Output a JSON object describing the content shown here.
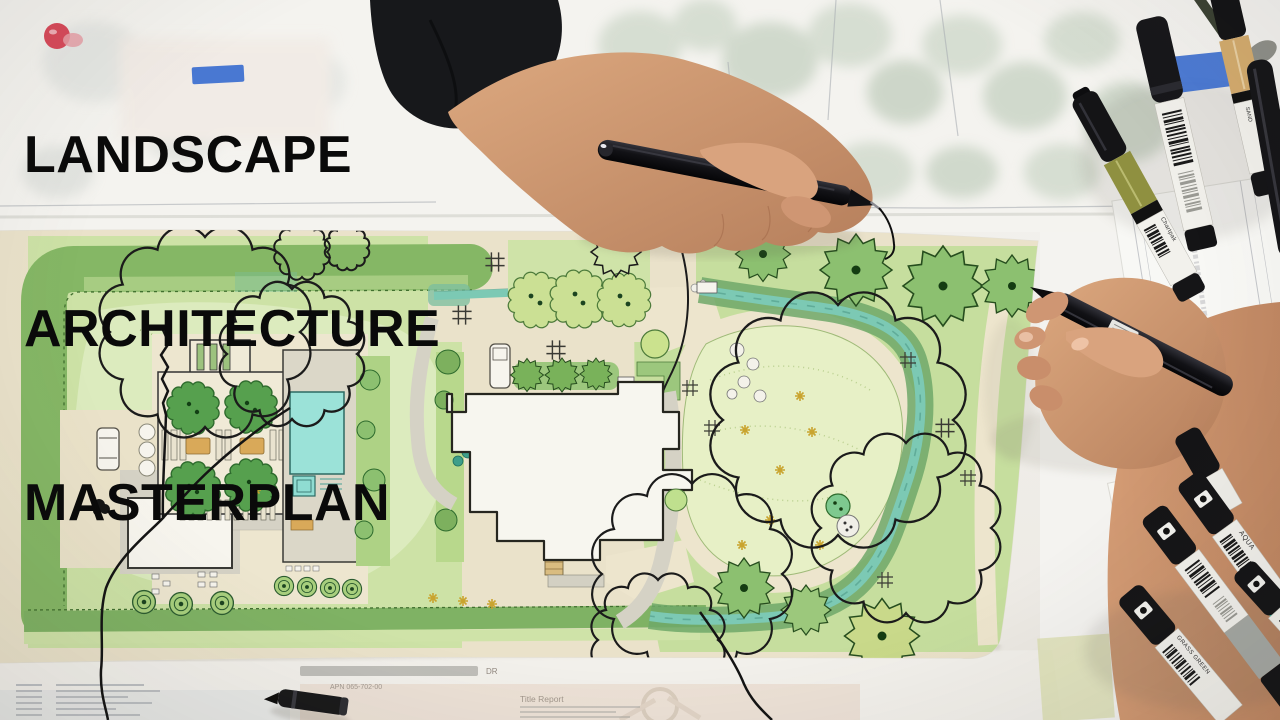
{
  "title": {
    "lines": [
      "LANDSCAPE",
      "ARCHITECTURE",
      "MASTERPLAN"
    ]
  },
  "survey_sheet": {
    "vertical_label": "Topographic Su",
    "note_fragment": "ALL EASEMENTS"
  },
  "underlay": {
    "bearing_fragment": "N 89°17'05'01\"",
    "street_fragment": "DR",
    "apn_fragment": "APN 065-702-00",
    "title_block_fragment": "Title Report"
  },
  "markers": {
    "brand_fragment": "Chartpak",
    "top_right": [
      {
        "name": "white-body-marker",
        "band_color": "#F0EFEA"
      },
      {
        "name": "olive-marker",
        "band_color": "#8F9040"
      },
      {
        "name": "sand-marker",
        "band_color": "#D4AC6E",
        "label_lines": [
          "SAND",
          "DE SABLE"
        ]
      },
      {
        "name": "black-marker",
        "band_color": "#1C1C1E"
      }
    ],
    "bottom_right": [
      {
        "name": "grass-green-marker",
        "band_color": "#6FA94E",
        "label": "GRASS GREEN"
      },
      {
        "name": "gray-marker",
        "band_color": "#A6A9A4"
      },
      {
        "name": "aqua-marker",
        "band_color": "#2EB9A0",
        "label": "AQUA"
      },
      {
        "name": "green-marker",
        "band_color": "#6FA94E"
      }
    ]
  },
  "plan_features": [
    "hedge-border",
    "lawn",
    "meadow",
    "guest-house",
    "pergola-courtyard",
    "courtyard-trees",
    "pool-house",
    "pool",
    "spa",
    "main-house",
    "wood-deck",
    "driveway",
    "cars",
    "stream",
    "central-meadow",
    "stepping-stones",
    "shrub-row",
    "flower-specks",
    "tree-canopy-outlines"
  ],
  "palette": {
    "desk": "#F0EEEA",
    "paper": "#FCFCF8",
    "hedge_green": "#85B765",
    "lawn_green": "#CDE2A6",
    "meadow_green": "#E7F0C6",
    "path_beige": "#EAE2CA",
    "pool_aqua": "#9BE2D8",
    "stream_teal": "#7CC9B4",
    "ink_black": "#141414",
    "tape_blue": "#3B6ED0",
    "skin": "#C98C6F",
    "sleeve_black": "#17181B"
  }
}
